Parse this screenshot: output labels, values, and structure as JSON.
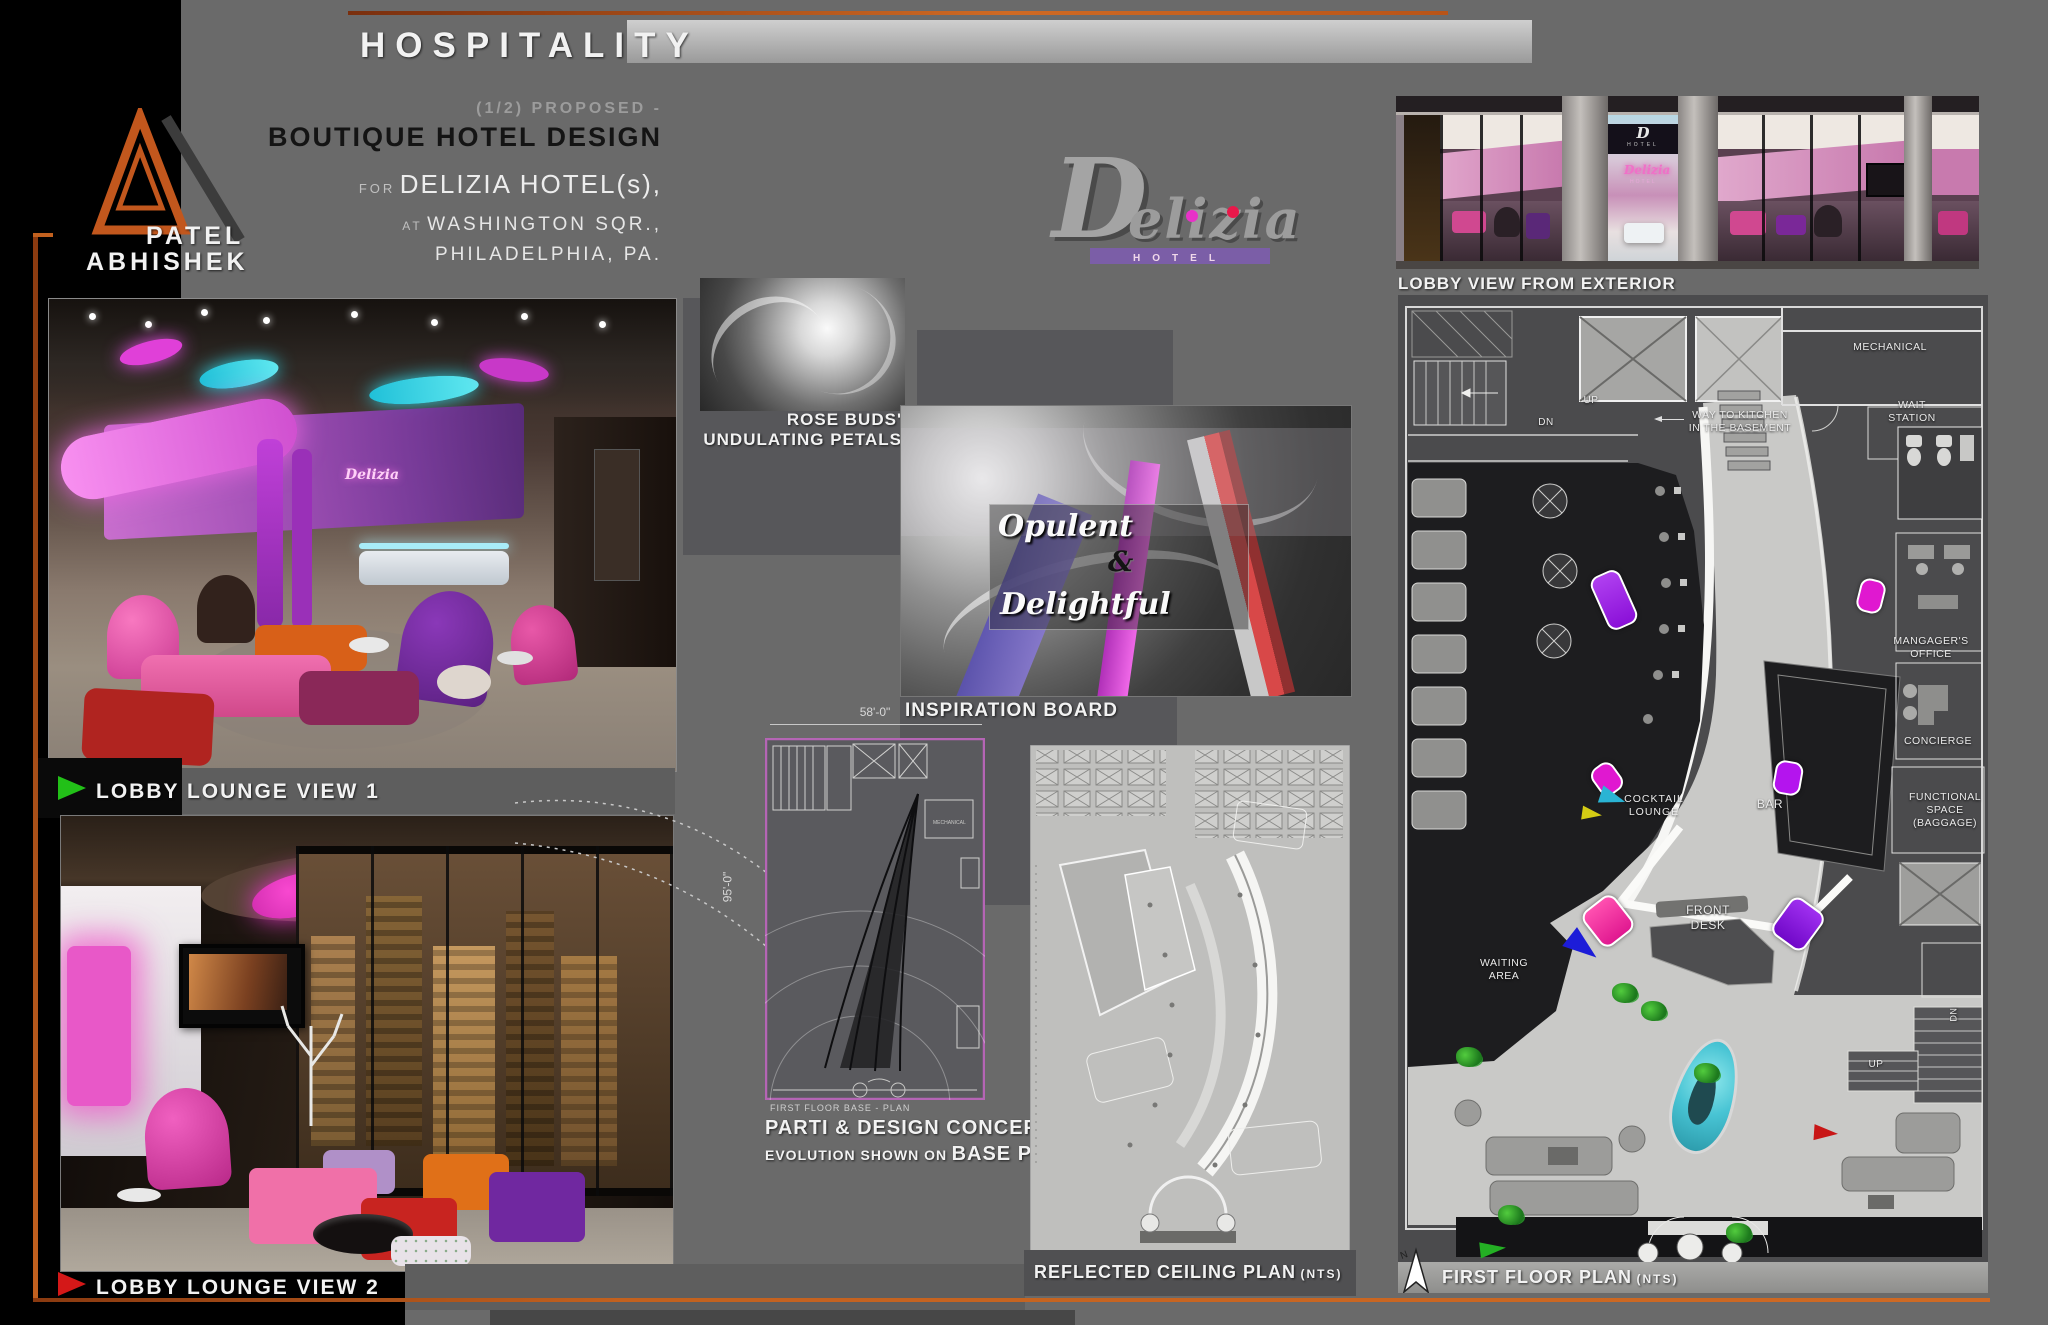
{
  "canvas": {
    "width": 2048,
    "height": 1325
  },
  "colors": {
    "background": "#6a6a6a",
    "panel_dark": "#57575a",
    "black": "#000000",
    "accent_orange": "#c2611f",
    "title_black": "#141414",
    "text_light": "#f2f2f2",
    "text_gray": "#9c9c9c",
    "logo_purple_bar": "#7b5ea7",
    "logo_dot_pink": "#e832c8",
    "logo_dot_red": "#e8184a",
    "plan_dark": "#4b4b4d",
    "plan_floor": "#c9c9c7",
    "plan_black": "#1d1d1f",
    "accent_magenta": "#e018d0",
    "accent_purple": "#8a10e8",
    "accent_cyan": "#4fd0de",
    "arrow_green": "#22c018",
    "arrow_red": "#d41818",
    "arrow_blue": "#1c1cd8",
    "arrow_yellow": "#d4cc14",
    "parti_border": "#b565b5"
  },
  "header": {
    "title": "HOSPITALITY"
  },
  "author": {
    "first_name": "PATEL",
    "last_name": "ABHISHEK"
  },
  "project": {
    "sequence": "(1/2)",
    "status": "PROPOSED -",
    "title": "BOUTIQUE HOTEL DESIGN",
    "for_word": "FOR",
    "client": "DELIZIA HOTEL(s),",
    "at_word": "AT",
    "address": "WASHINGTON SQR.,",
    "city": "PHILADELPHIA, PA."
  },
  "brand": {
    "initial": "D",
    "script": "elizia",
    "sub": "HOTEL"
  },
  "lobby1": {
    "label": "LOBBY LOUNGE VIEW 1",
    "wall_sign": "Delizia"
  },
  "lobby2": {
    "label": "LOBBY LOUNGE VIEW 2"
  },
  "rose": {
    "label_line1": "ROSE BUDS'",
    "label_line2": "UNDULATING PETALS"
  },
  "inspiration": {
    "label": "INSPIRATION BOARD",
    "overlay_word1": "Opulent",
    "overlay_amp": "&",
    "overlay_word2": "Delightful"
  },
  "parti": {
    "dim_width": "58'-0\"",
    "dim_height": "95'-0\"",
    "mech_label": "MECHANICAL",
    "base_caption": "FIRST FLOOR BASE - PLAN",
    "caption_line1": "PARTI & DESIGN CONCEPT",
    "caption_line2_small": "EVOLUTION SHOWN ON",
    "caption_line2_big": "BASE PLAN"
  },
  "rcp": {
    "label": "REFLECTED CEILING PLAN",
    "scale_note": "(NTS)"
  },
  "exterior": {
    "label": "LOBBY VIEW FROM EXTERIOR",
    "sign_initial": "D",
    "sign_sub": "HOTEL",
    "interior_sign": "Delizia",
    "interior_sign_sub": "HOTEL"
  },
  "floor_plan": {
    "label": "FIRST FLOOR PLAN",
    "scale_note": "(NTS)",
    "north": "N",
    "rooms": {
      "mechanical": "MECHANICAL",
      "kitchen_l1": "WAY TO KITCHEN",
      "kitchen_l2": "IN THE BASEMENT",
      "wait_l1": "WAIT",
      "wait_l2": "STATION",
      "up_top": "UP",
      "dn_top": "DN",
      "managers_l1": "MANGAGER'S",
      "managers_l2": "OFFICE",
      "concierge": "CONCIERGE",
      "functional_l1": "FUNCTIONAL",
      "functional_l2": "SPACE",
      "functional_l3": "(BAGGAGE)",
      "cocktail_l1": "COCKTAIL",
      "cocktail_l2": "LOUNGE",
      "bar": "BAR",
      "frontdesk_l1": "FRONT",
      "frontdesk_l2": "DESK",
      "waiting_l1": "WAITING",
      "waiting_l2": "AREA",
      "up_lobby": "UP",
      "dn_side": "DN"
    }
  }
}
